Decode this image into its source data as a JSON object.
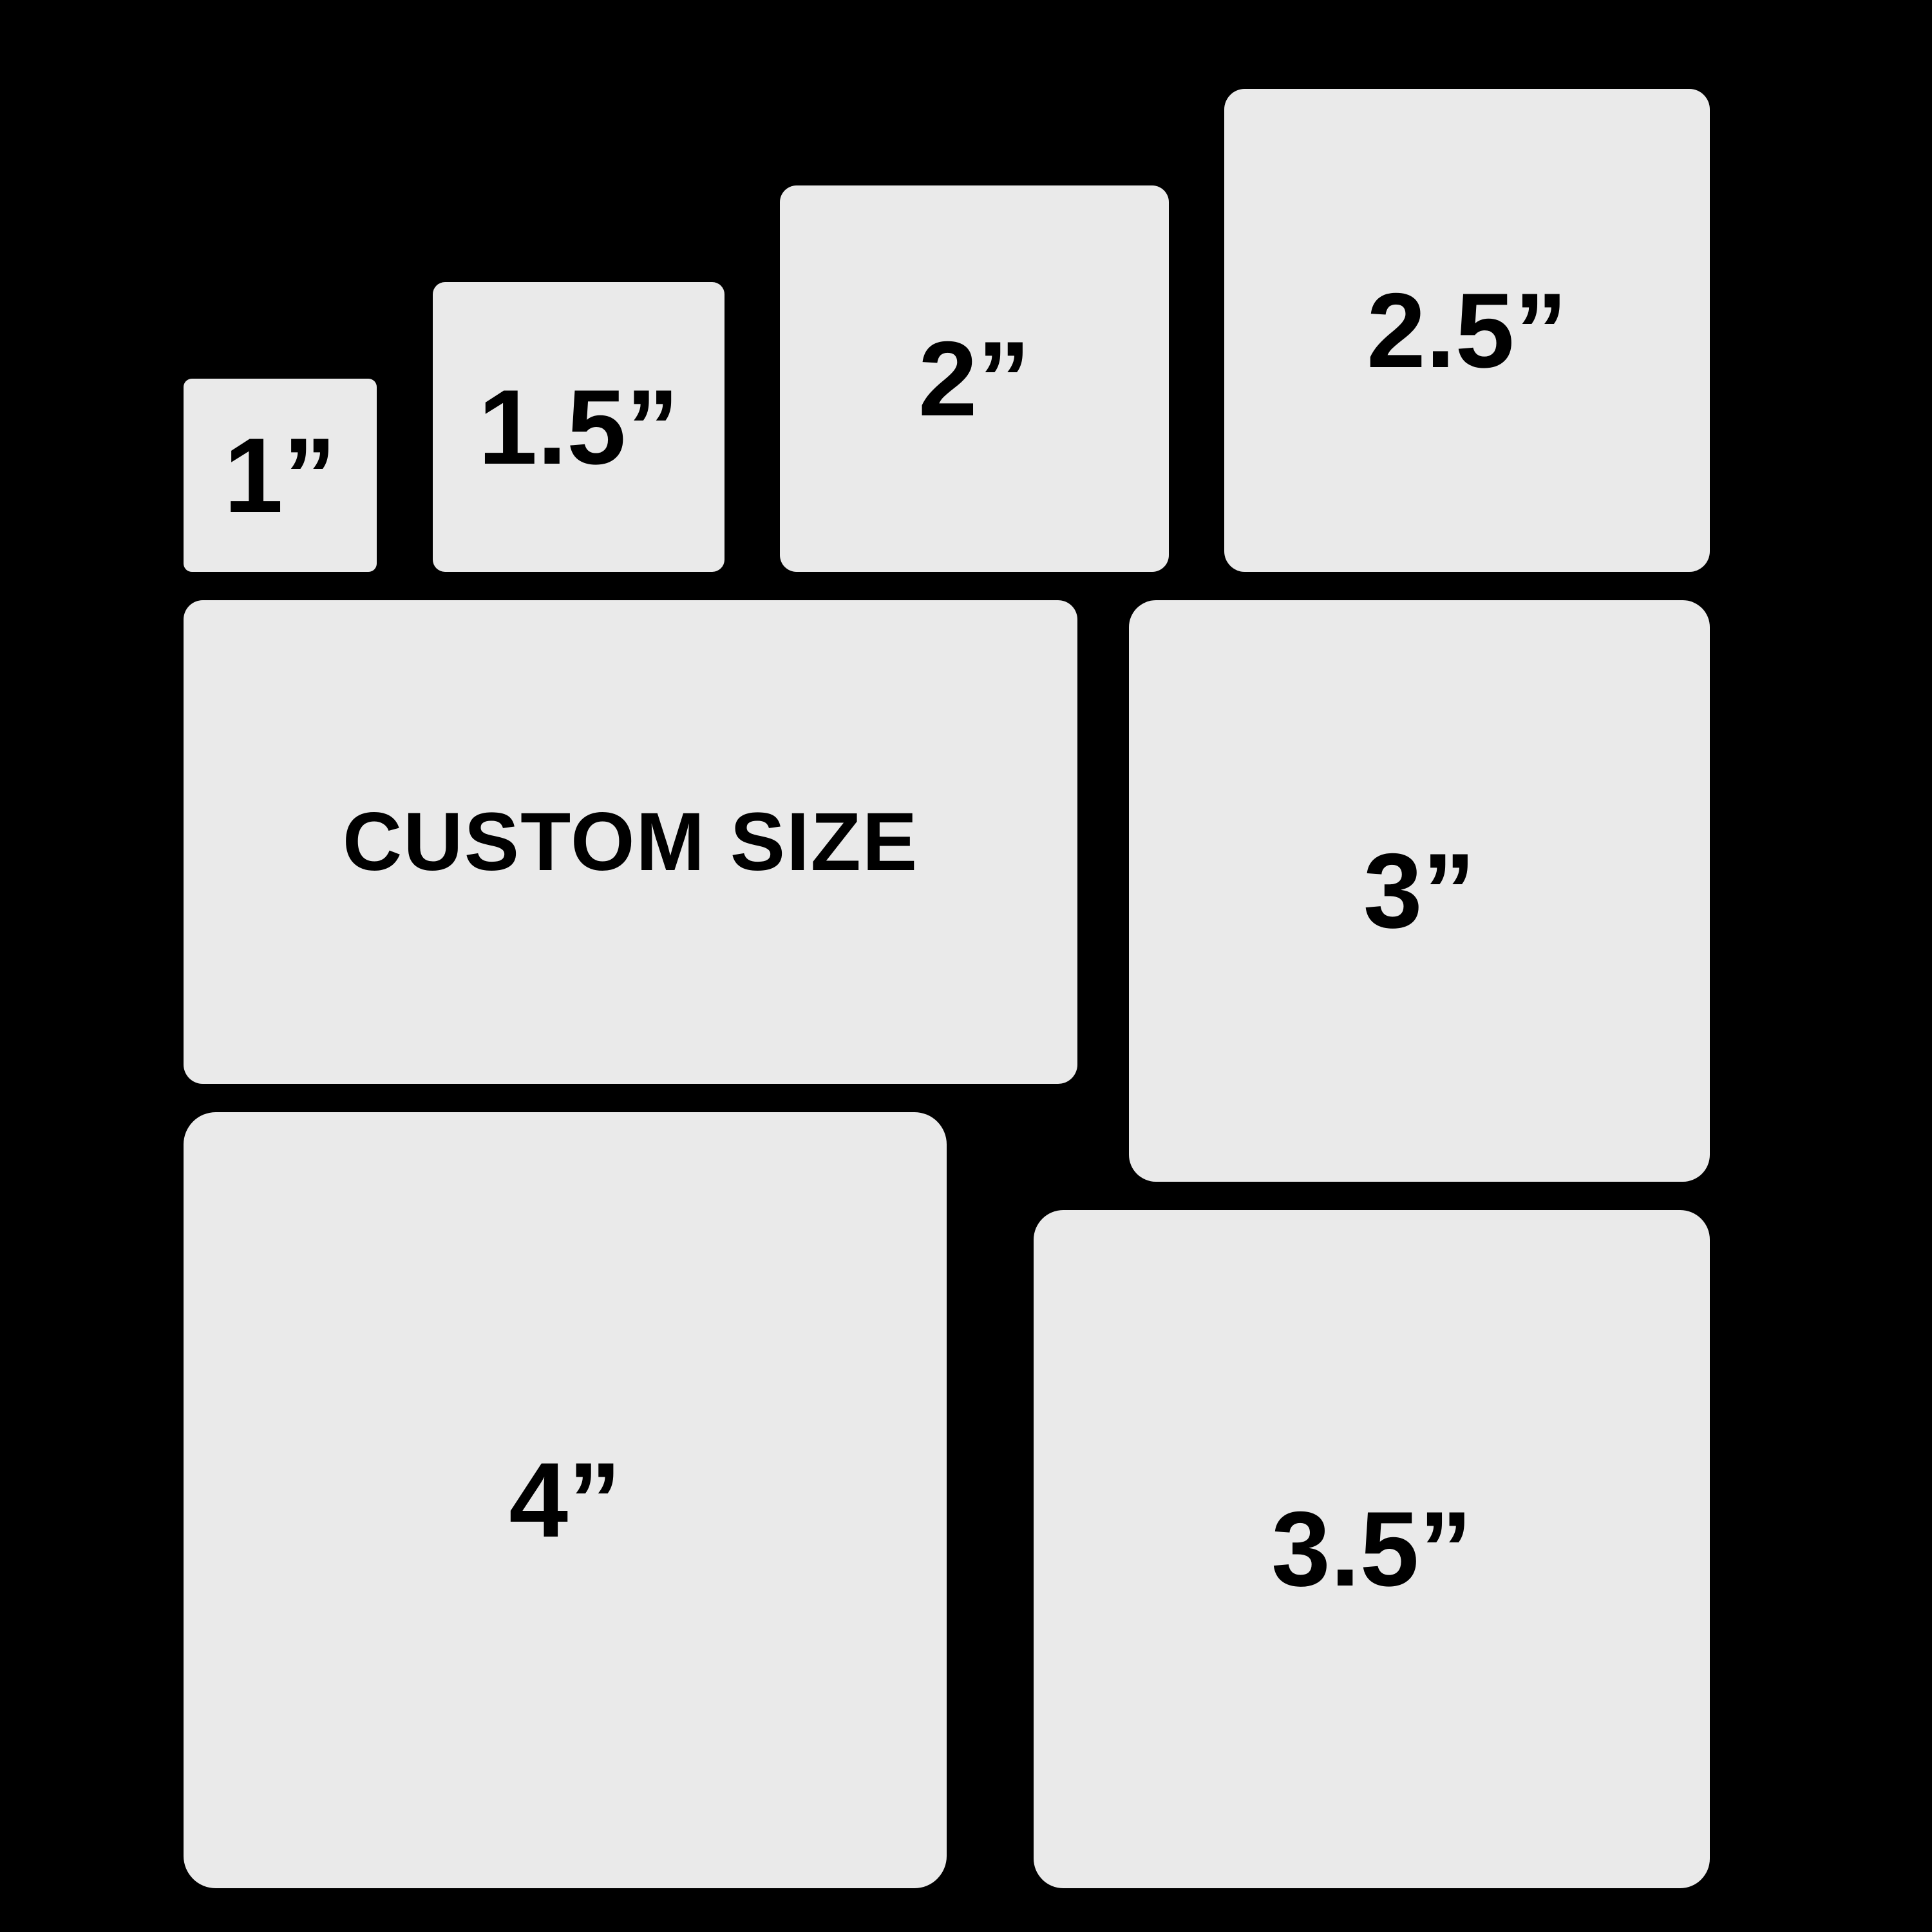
{
  "colors": {
    "background": "#000000",
    "box_fill": "#eaeaea",
    "text": "#000000"
  },
  "size_chart": {
    "description_type": "sticker-size-comparison-diagram",
    "unit": "inch",
    "boxes": [
      {
        "id": "size-1in",
        "label": "1”",
        "size_inches": 1
      },
      {
        "id": "size-1-5in",
        "label": "1.5”",
        "size_inches": 1.5
      },
      {
        "id": "size-2in",
        "label": "2”",
        "size_inches": 2
      },
      {
        "id": "size-2-5in",
        "label": "2.5”",
        "size_inches": 2.5
      },
      {
        "id": "custom",
        "label": "CUSTOM SIZE",
        "size_inches": null
      },
      {
        "id": "size-3in",
        "label": "3”",
        "size_inches": 3
      },
      {
        "id": "size-4in",
        "label": "4”",
        "size_inches": 4
      },
      {
        "id": "size-3-5in",
        "label": "3.5”",
        "size_inches": 3.5
      }
    ]
  }
}
